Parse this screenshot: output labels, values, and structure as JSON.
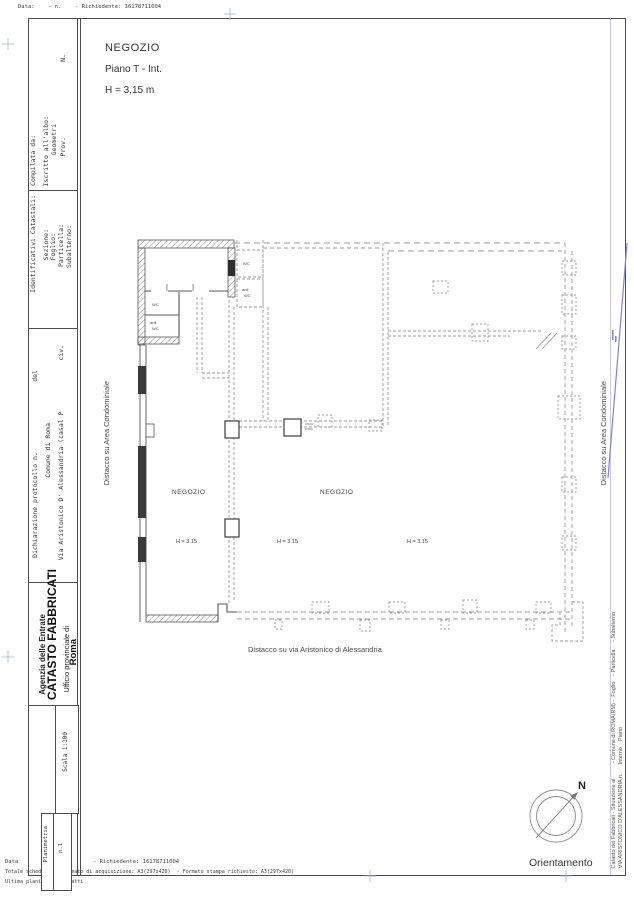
{
  "top_header": {
    "data_label": "Data:",
    "n_label": "- n.",
    "richiedente": "- Richiedente: 16178711004"
  },
  "left_band": {
    "compilata": {
      "line1": "Compilata da:",
      "line2": "Iscritto all'albo:",
      "line3": "Geometri",
      "line4": "Prov.",
      "n_label": "N."
    },
    "identificativi": {
      "title": "Identificativi Catastali:",
      "item1": "Sezione:",
      "item2": "Foglio:",
      "item3": "Particella:",
      "item4": "Subalterno:"
    },
    "dichiarazione": {
      "line1": "Dichiarazione protocollo n.                  del",
      "line2": "Comune di Roma",
      "line3": "Via Aristonico D' Alessandria (casal P             civ."
    },
    "agency": {
      "line1": "Agenzia delle Entrate",
      "line2": "CATASTO FABBRICATI",
      "line3": "Ufficio provinciale di",
      "line4": "Roma"
    },
    "scala": "Scala 1:100",
    "planimetria": "Planimetria",
    "n1": "n.1"
  },
  "title_block": {
    "line1": "NEGOZIO",
    "line2": "Piano T - Int.",
    "line3": "H = 3,15 m"
  },
  "plan": {
    "negozio_left": "NEGOZIO",
    "negozio_right": "NEGOZIO",
    "h1": "H = 3.15",
    "h2": "H = 3.15",
    "h3": "H = 3.15",
    "wc1": "WC",
    "antiwc1_l1": "anti",
    "antiwc1_l2": "WC",
    "wc2": "WC",
    "antiwc2_l1": "anti",
    "antiwc2_l2": "WC",
    "distacco_left": "Distacco su Area Condominiale",
    "distacco_right": "Distacco su Area Condominiale",
    "distacco_bottom": "Distacco su via Aristonico di Alessandria"
  },
  "compass": {
    "n": "N",
    "caption": "Orientamento"
  },
  "right_strip": {
    "line1": "Catasto dei Fabbricati - Situazione al          - Comune di ROMA(RM) -  Foglio    - Particella     - Subalterno",
    "line2": "VIA ARISTONICO D'ALESSANDRIA n.      Interno    Piano"
  },
  "footer": {
    "line1_a": "Data",
    "line1_b": "- Richiedente: 16178711004",
    "line2": "Totale schede: 1 - Formato di acquisizione: A3(297x420)  - Formato stampa richiesto: A3(297x420)",
    "line3": "Ultima planimetria in atti"
  },
  "colors": {
    "accent_blue": "#7f84d4",
    "border_dark": "#4d4d4d",
    "dash_gray": "#9b9b9b"
  }
}
